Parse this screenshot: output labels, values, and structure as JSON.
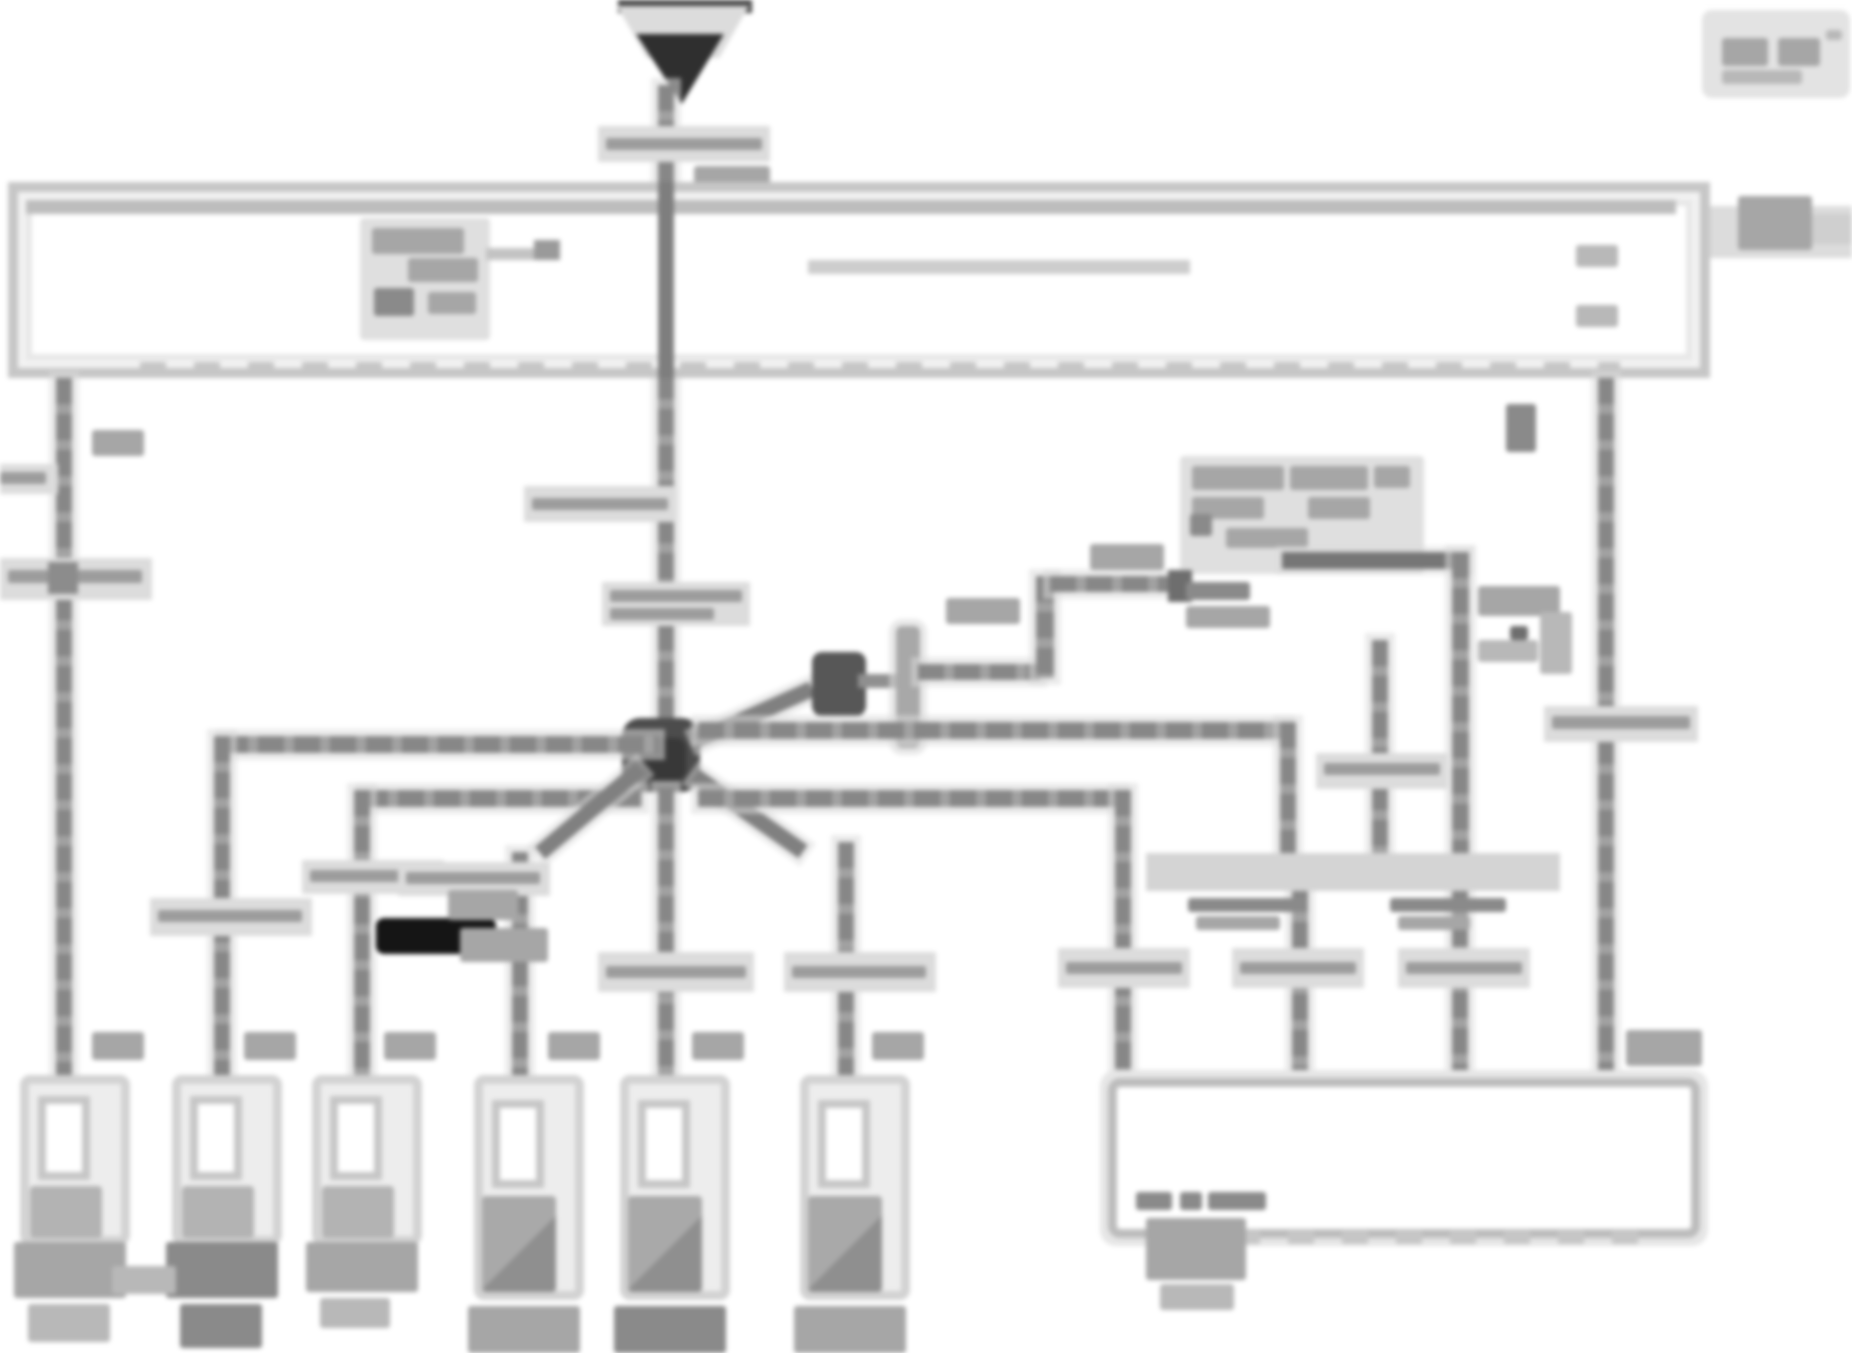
{
  "meta": {
    "kind": "scanned automotive wiring diagram",
    "legibility": "extremely low resolution — all printed text is illegible blobs",
    "background": "#ffffff"
  },
  "palette": {
    "wire_gray": "#8f8f8f",
    "wire_dark": "#737373",
    "halo_gray": "#dbdbdb",
    "box_border": "#c6c6c6",
    "inner_border": "#e7e7e7",
    "blob_text": "#a6a6a6",
    "splice_dark": "#4c4c4c",
    "heavy_black": "#151515",
    "tick_band": "#dcdcdc"
  },
  "diagram": {
    "title_stamp": {
      "name": "title-stamp",
      "text": ""
    },
    "power_feed": {
      "name": "power-feed-arrow",
      "style": "solid dark down-arrow from top edge"
    },
    "junction_box": {
      "name": "fuse-junction-box",
      "label_text": "",
      "has_dashed_bottom_edge": true,
      "right_exit_connector": true
    },
    "splice_hub": {
      "name": "splice-hub",
      "branch_count": 8
    },
    "inline_connector": {
      "name": "inline-connector-bar"
    },
    "relay_block": {
      "name": "relay-label-cluster",
      "label_text": ""
    },
    "bus_band": {
      "name": "horizontal-wire-band",
      "label_text": ""
    },
    "ecm_box": {
      "name": "ecm-box",
      "label_text": "",
      "has_dashed_bottom_edge": true,
      "top_entries": 4
    },
    "heavy_link": {
      "name": "black-heavy-link-bar"
    },
    "bottom_connectors": [
      {
        "id": "connector-1",
        "label_text": ""
      },
      {
        "id": "connector-2",
        "label_text": ""
      },
      {
        "id": "connector-3",
        "label_text": ""
      },
      {
        "id": "connector-4",
        "label_text": ""
      },
      {
        "id": "connector-5",
        "label_text": ""
      },
      {
        "id": "connector-6",
        "label_text": ""
      }
    ],
    "wire_label_ticks": 14
  }
}
